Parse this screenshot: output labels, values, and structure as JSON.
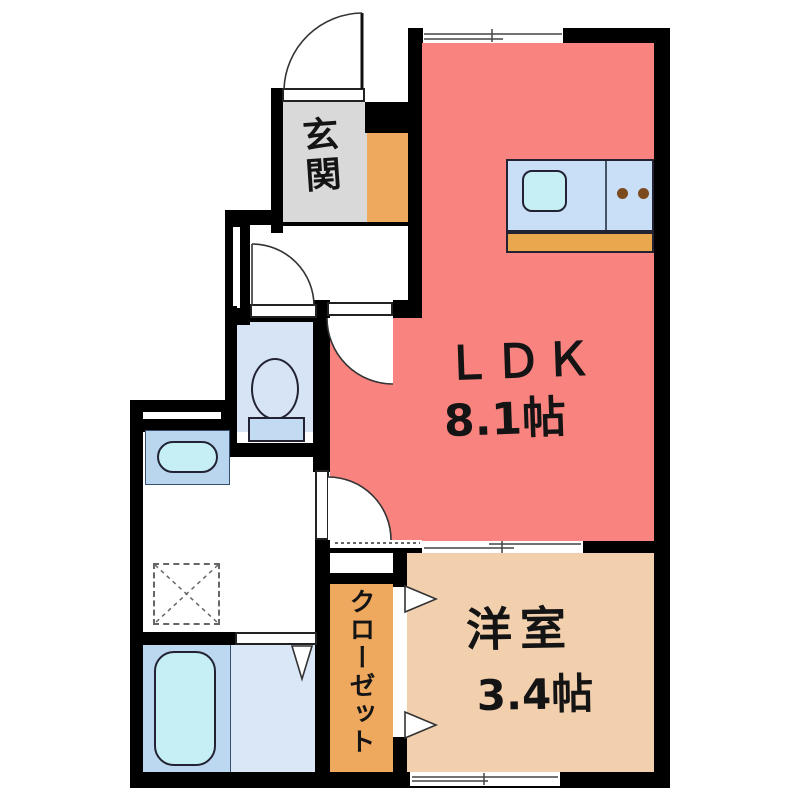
{
  "plan_title": "1K apartment floor plan",
  "rooms": {
    "genkan": {
      "label": "玄関"
    },
    "ldk": {
      "label": "ＬＤＫ",
      "size": "8.1帖"
    },
    "western_room": {
      "label": "洋室",
      "size": "3.4帖"
    },
    "closet": {
      "label": "クローゼット"
    }
  },
  "colors": {
    "wall": "#000000",
    "ldk": "#f8837f",
    "western_room": "#f2d0ae",
    "closet": "#efa95e",
    "shoe_cabinet": "#efa95e",
    "genkan_floor": "#d9d9d9",
    "toilet_room": "#d6e4f6",
    "bathtub_zone": "#bcd7f0",
    "shower_zone": "#d9e7f7",
    "vanity": "#b9d6ee",
    "fixture_cyan": "#c5eef5",
    "kitchen_counter": "#c9dff7",
    "kitchen_base": "#e9a74e",
    "burner_brown": "#7b4a1e"
  }
}
